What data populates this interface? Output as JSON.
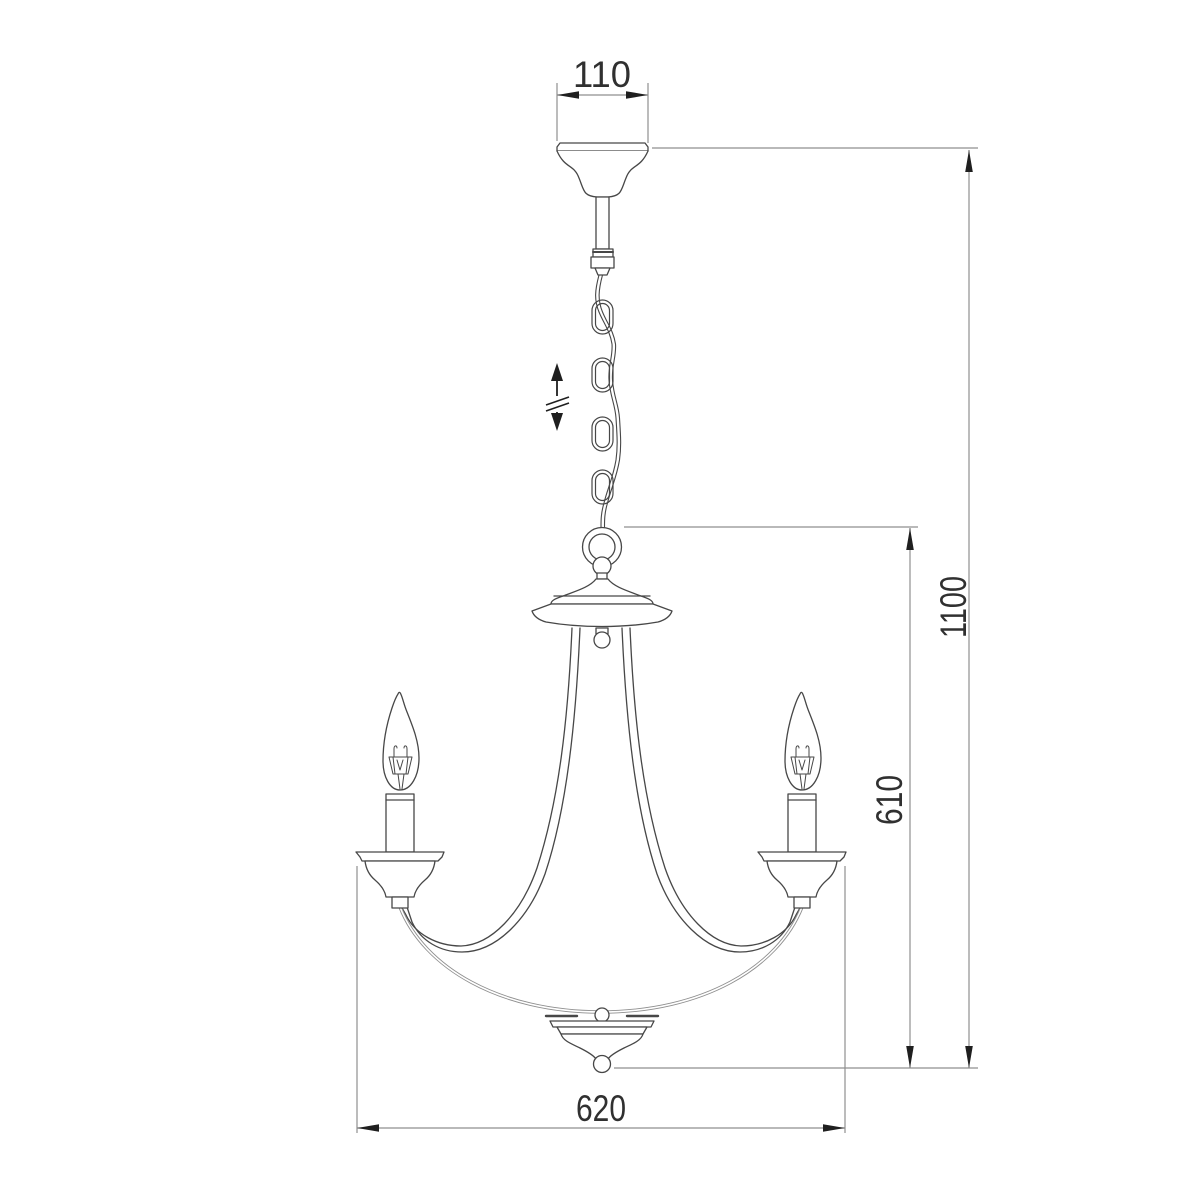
{
  "drawing": {
    "subject": "chandelier-line-drawing",
    "dimensions": {
      "canopy_width": "110",
      "overall_height": "1100",
      "body_height": "610",
      "body_width": "620"
    },
    "symbols": {
      "height_adjustable": "up-down-arrow"
    },
    "colors": {
      "outline": "#474747",
      "dimension_line": "#8f8f8f",
      "arrowhead": "#1f1f1f",
      "text": "#303030",
      "background": "#ffffff"
    }
  }
}
